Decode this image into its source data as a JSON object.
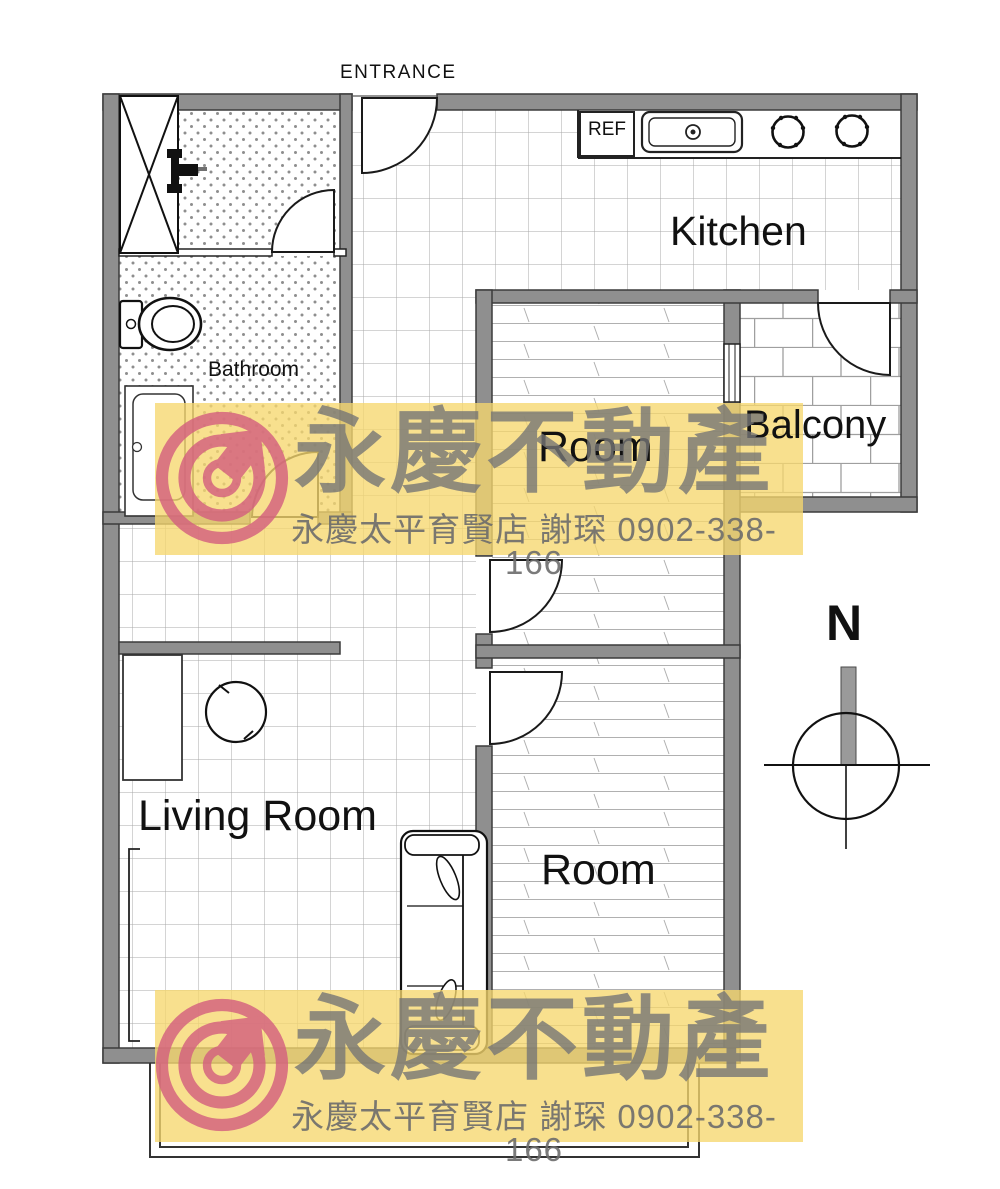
{
  "plan": {
    "entrance": "ENTRANCE",
    "labels": {
      "kitchen": "Kitchen",
      "bathroom": "Bathroom",
      "room_center": "Room",
      "room_bottom": "Room",
      "balcony": "Balcony",
      "living_room": "Living Room"
    },
    "fixtures": {
      "refrigerator": "REF"
    },
    "compass": {
      "north": "N"
    }
  },
  "watermark": {
    "brand": "永慶不動產",
    "store_line": "永慶太平育賢店  謝琛 0902-338-166",
    "colors": {
      "band": "#f6d76e",
      "text_gray": "#787878",
      "logo_pink": "#d4607f"
    }
  }
}
